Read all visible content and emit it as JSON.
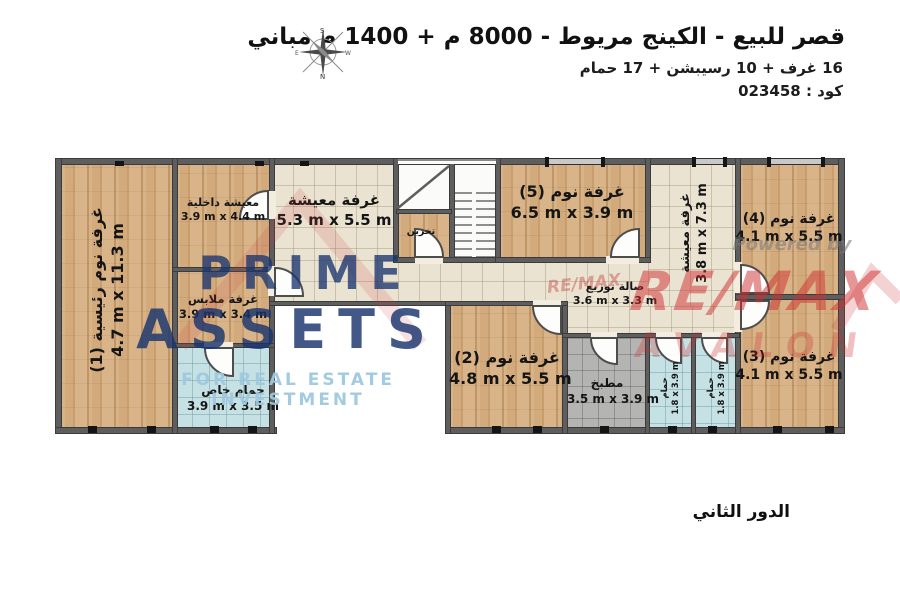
{
  "header": {
    "title": "قصر للبيع - الكينج مريوط - 8000 م + 1400 م مباني",
    "subtitle": "16 غرف + 10 رسيبشن + 17 حمام",
    "code": "كود : 023458"
  },
  "floor_label": "الدور الثاني",
  "compass": {
    "n": "N",
    "s": "S",
    "e": "E",
    "w": "W"
  },
  "watermarks": {
    "prime_word1": "PRIME",
    "prime_word2": "ASSETS",
    "prime_tagline": "FOR REAL ESTATE INVESTMENT",
    "powered_by": "Powered by",
    "remax": "RE/MAX",
    "remax_small": "RE/MAX",
    "avalon": "AVALON"
  },
  "rooms": {
    "master_bedroom": {
      "name": "غرفة نوم رئيسية (1)",
      "dims": "4.7 m x 11.3 m"
    },
    "inner_living": {
      "name": "معيشة داخلية",
      "dims": "3.9 m x 4.4 m"
    },
    "dressing_room": {
      "name": "غرفة ملابس",
      "dims": "3.9 m x 3.4 m"
    },
    "private_bathroom": {
      "name": "حمام خاص",
      "dims": "3.9 m x 3.5 m"
    },
    "living_room_1": {
      "name": "غرفة معيشة",
      "dims": "5.3 m x 5.5 m"
    },
    "storage": {
      "name": "تخزين"
    },
    "bedroom_5": {
      "name": "غرفة نوم (5)",
      "dims": "6.5 m x 3.9 m"
    },
    "living_room_2": {
      "name": "غرفة معيشة",
      "dims": "3.8 m x 7.3 m"
    },
    "distribution_hall": {
      "name": "صالة توزيع",
      "dims": "3.6 m x 3.3 m"
    },
    "bedroom_2": {
      "name": "غرفة نوم (2)",
      "dims": "4.8 m x 5.5 m"
    },
    "kitchen": {
      "name": "مطبخ",
      "dims": "3.5 m x 3.9 m"
    },
    "bathroom_1": {
      "name": "حمام",
      "dims": "1.8 x 3.9 m"
    },
    "bathroom_2": {
      "name": "حمام",
      "dims": "1.8 x 3.9 m"
    },
    "bedroom_4": {
      "name": "غرفة نوم (4)",
      "dims": "4.1 m x 5.5 m"
    },
    "bedroom_3": {
      "name": "غرفة نوم (3)",
      "dims": "4.1 m x 5.5 m"
    }
  },
  "colors": {
    "wood_floor": "#d3aa7b",
    "tile_floor": "#ebe3d2",
    "bath_floor": "#c6e1e4",
    "kitchen_floor": "#b4b4b2",
    "wall": "#5e5e5e",
    "prime_navy": "#19346e",
    "prime_light_blue": "#9ec8de",
    "remax_red": "#cd2d30"
  }
}
